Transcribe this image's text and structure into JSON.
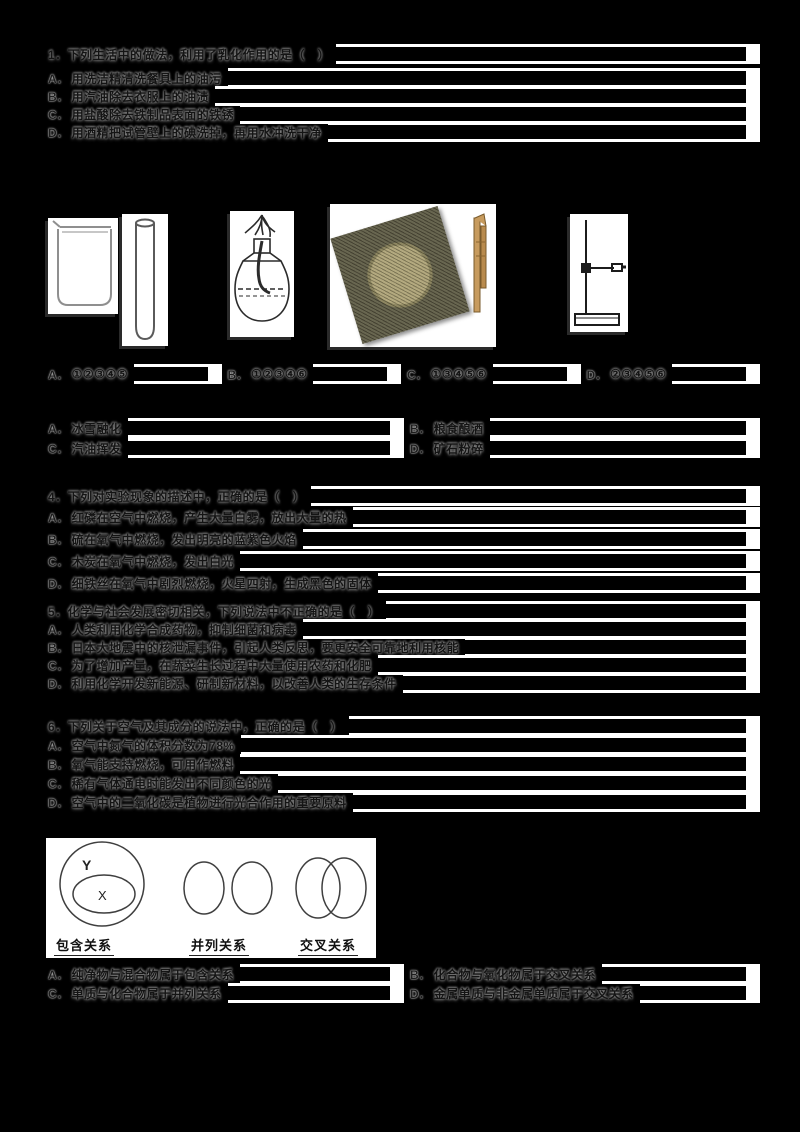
{
  "page": {
    "background": "#000000",
    "paper_white": "#ffffff",
    "bar_black": "#000000"
  },
  "q1": {
    "stem": "1．下列生活中的做法，利用了乳化作用的是（　）",
    "o": [
      {
        "l": "A．",
        "t": "用洗洁精清洗餐具上的油污"
      },
      {
        "l": "B．",
        "t": "用汽油除去衣服上的油渍"
      },
      {
        "l": "C．",
        "t": "用盐酸除去铁制品表面的铁锈"
      },
      {
        "l": "D．",
        "t": "用酒精把试管壁上的碘洗掉，再用水冲洗干净"
      }
    ]
  },
  "q2": {
    "equipment_icons": [
      "beaker",
      "test-tube",
      "alcohol-lamp",
      "wire-gauze",
      "test-tube-holder",
      "iron-stand"
    ],
    "o": [
      {
        "l": "A．",
        "t": "①②③④⑤"
      },
      {
        "l": "B．",
        "t": "①②③④⑥"
      },
      {
        "l": "C．",
        "t": "①③④⑤⑥"
      },
      {
        "l": "D．",
        "t": "②③④⑤⑥"
      }
    ]
  },
  "q3": {
    "o": [
      {
        "l": "A．",
        "t": "冰雪融化"
      },
      {
        "l": "B．",
        "t": "粮食酿酒"
      },
      {
        "l": "C．",
        "t": "汽油挥发"
      },
      {
        "l": "D．",
        "t": "矿石粉碎"
      }
    ]
  },
  "q4": {
    "stem": "4．下列对实验现象的描述中，正确的是（　）",
    "o": [
      {
        "l": "A．",
        "t": "红磷在空气中燃烧，产生大量白雾，放出大量的热"
      },
      {
        "l": "B．",
        "t": "硫在氧气中燃烧，发出明亮的蓝紫色火焰"
      },
      {
        "l": "C．",
        "t": "木炭在氧气中燃烧，发出白光"
      },
      {
        "l": "D．",
        "t": "细铁丝在氧气中剧烈燃烧，火星四射，生成黑色的固体"
      }
    ]
  },
  "q5": {
    "stem": "5．化学与社会发展密切相关，下列说法中不正确的是（　）",
    "o": [
      {
        "l": "A．",
        "t": "人类利用化学合成药物，抑制细菌和病毒"
      },
      {
        "l": "B．",
        "t": "日本大地震中的核泄漏事件，引起人类反思，要更安全可靠地利用核能"
      },
      {
        "l": "C．",
        "t": "为了增加产量，在蔬菜生长过程中大量使用农药和化肥"
      },
      {
        "l": "D．",
        "t": "利用化学开发新能源、研制新材料，以改善人类的生存条件"
      }
    ]
  },
  "q6": {
    "stem": "6．下列关于空气及其成分的说法中，正确的是（　）",
    "o": [
      {
        "l": "A．",
        "t": "空气中氮气的体积分数为78%"
      },
      {
        "l": "B．",
        "t": "氧气能支持燃烧，可用作燃料"
      },
      {
        "l": "C．",
        "t": "稀有气体通电时能发出不同颜色的光"
      },
      {
        "l": "D．",
        "t": "空气中的二氧化碳是植物进行光合作用的重要原料"
      }
    ]
  },
  "q7": {
    "venn": {
      "labels": [
        "包含关系",
        "并列关系",
        "交叉关系"
      ],
      "outer": "Y",
      "inner": "X"
    },
    "o": [
      {
        "l": "A．",
        "t": "纯净物与混合物属于包含关系"
      },
      {
        "l": "B．",
        "t": "化合物与氧化物属于交叉关系"
      },
      {
        "l": "C．",
        "t": "单质与化合物属于并列关系"
      },
      {
        "l": "D．",
        "t": "金属单质与非金属单质属于交叉关系"
      }
    ]
  }
}
